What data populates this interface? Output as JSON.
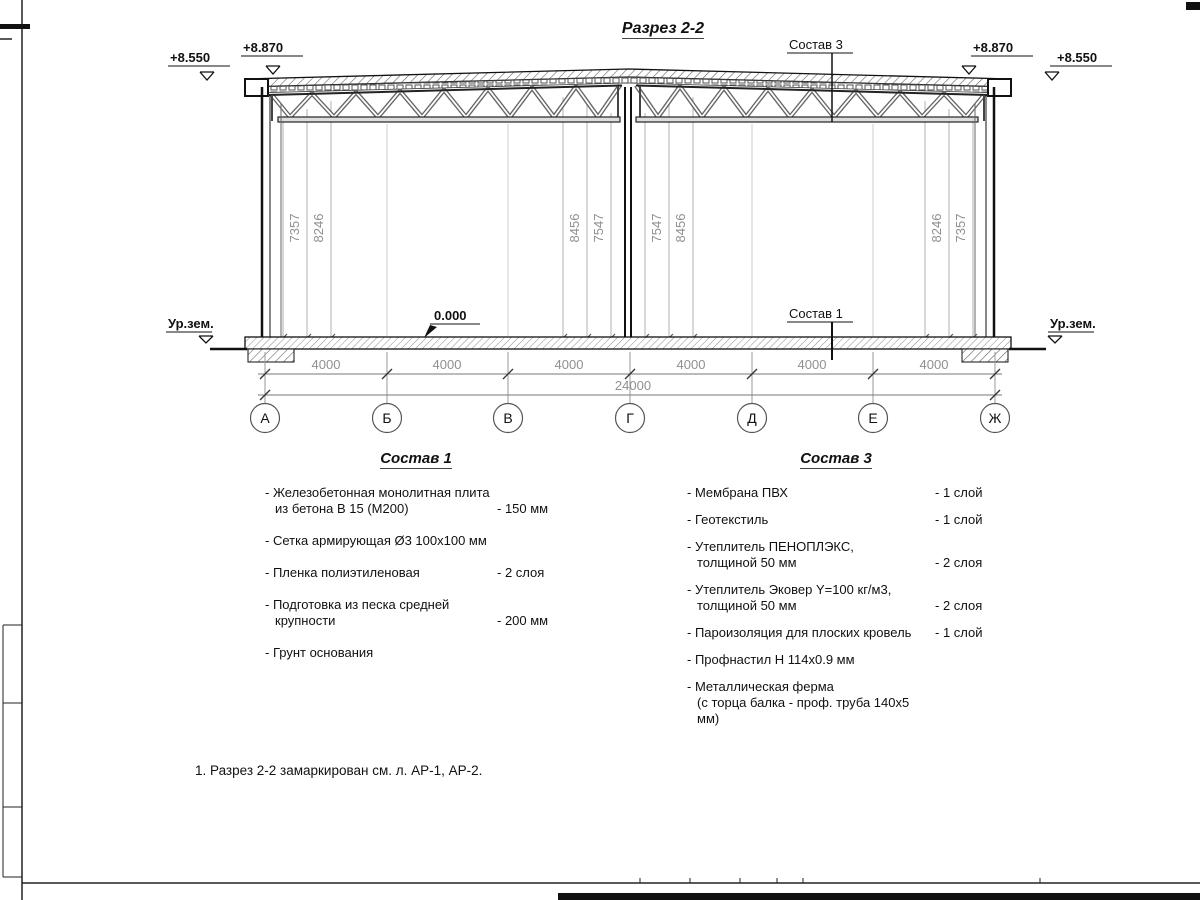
{
  "sheet": {
    "title": "Разрез 2-2",
    "note": "1. Разрез 2-2 замаркирован см. л. АР-1, АР-2."
  },
  "drawing": {
    "levels": {
      "left_outer": "+8.550",
      "left_parapet": "+8.870",
      "right_parapet": "+8.870",
      "right_outer": "+8.550",
      "floor_zero": "0.000"
    },
    "ground_level_label": "Ур.зем.",
    "callout_roof": "Состав 3",
    "callout_floor": "Состав 1",
    "axes": [
      "А",
      "Б",
      "В",
      "Г",
      "Д",
      "Е",
      "Ж"
    ],
    "dims_horizontal": {
      "bays": [
        "4000",
        "4000",
        "4000",
        "4000",
        "4000",
        "4000"
      ],
      "total": "24000"
    },
    "dims_vertical": {
      "left": [
        "7357",
        "8246"
      ],
      "center_left": [
        "8456",
        "7547"
      ],
      "center_right": [
        "7547",
        "8456"
      ],
      "right": [
        "8246",
        "7357"
      ]
    }
  },
  "composition1": {
    "heading": "Состав 1",
    "items": [
      {
        "name": "- Железобетонная  монолитная плита",
        "name2": "из бетона В 15 (М200)",
        "value": "- 150 мм"
      },
      {
        "name": "- Сетка армирующая Ø3 100х100 мм",
        "name2": "",
        "value": ""
      },
      {
        "name": "- Пленка полиэтиленовая",
        "name2": "",
        "value": "-  2 слоя"
      },
      {
        "name": "- Подготовка из песка средней",
        "name2": "крупности",
        "value": "- 200 мм"
      },
      {
        "name": "- Грунт основания",
        "name2": "",
        "value": ""
      }
    ]
  },
  "composition3": {
    "heading": "Состав 3",
    "items": [
      {
        "name": "- Мембрана ПВХ",
        "name2": "",
        "value": "- 1 слой"
      },
      {
        "name": "- Геотекстиль",
        "name2": "",
        "value": "- 1 слой"
      },
      {
        "name": "- Утеплитель ПЕНОПЛЭКС,",
        "name2": "толщиной 50 мм",
        "value": "- 2 слоя"
      },
      {
        "name": "- Утеплитель Эковер Y=100 кг/м3,",
        "name2": "толщиной 50 мм",
        "value": "- 2 слоя"
      },
      {
        "name": "- Пароизоляция для плоских кровель",
        "name2": "",
        "value": "- 1 слой"
      },
      {
        "name": "- Профнастил Н 114х0.9 мм",
        "name2": "",
        "value": ""
      },
      {
        "name": "- Металлическая ферма",
        "name2": "(с торца балка - проф. труба 140х5 мм)",
        "value": ""
      }
    ]
  }
}
